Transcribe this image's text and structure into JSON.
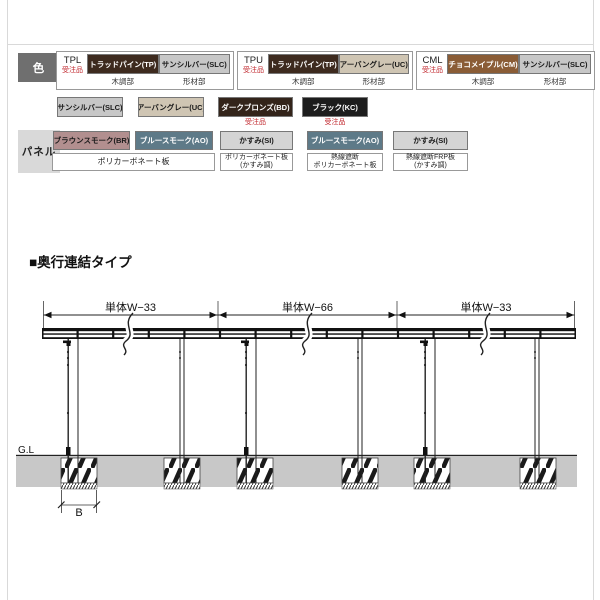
{
  "colors_row": {
    "header": "色",
    "order_note": "受注品",
    "wood_part": "木調部",
    "frame_part": "形材部",
    "groups": [
      {
        "code": "TPL",
        "wood": "トラッドパイン(TP)",
        "frame": "サンシルバー(SLC)"
      },
      {
        "code": "TPU",
        "wood": "トラッドパイン(TP)",
        "frame": "アーバングレー(UC)"
      },
      {
        "code": "CML",
        "wood": "チョコメイプル(CM)",
        "frame": "サンシルバー(SLC)"
      }
    ],
    "singles": [
      {
        "label": "サンシルバー(SLC)"
      },
      {
        "label": "アーバングレー(UC)"
      },
      {
        "label": "ダークブロンズ(BD)"
      },
      {
        "label": "ブラック(KC)"
      }
    ]
  },
  "panel_row": {
    "header": "パネル",
    "shared_material": "ポリカーボネート板",
    "items": [
      {
        "label": "ブラウンスモーク(BR)"
      },
      {
        "label": "ブルースモーク(AO)"
      },
      {
        "label": "かすみ(SI)",
        "material": "ポリカーボネート板\n(かすみ調)"
      },
      {
        "label": "ブルースモーク(AO)",
        "material": "熱線遮断\nポリカーボネート板"
      },
      {
        "label": "かすみ(SI)",
        "material": "熱線遮断FRP板\n(かすみ調)"
      }
    ]
  },
  "section_title": "■奥行連結タイプ",
  "diagram": {
    "span_labels": [
      "単体W−33",
      "単体W−66",
      "単体W−33"
    ],
    "ground_label": "G.L",
    "footing_width_label": "B"
  },
  "colors": {
    "trad_pine": "#3d2a1e",
    "sun_silver": "#c7c7c7",
    "urban_gray": "#cfc5b3",
    "choco_maple": "#8a5c36",
    "dark_bronze": "#33241a",
    "black": "#1d1d1d",
    "brown_smoke": "#b28f8f",
    "blue_smoke": "#5e7a88",
    "kasumi": "#d4d4d4",
    "order_red": "#c1272d",
    "header_dark_bg": "#6f6f6f",
    "header_light_bg": "#d9d9d9",
    "ground_gray": "#c8c8c8"
  }
}
